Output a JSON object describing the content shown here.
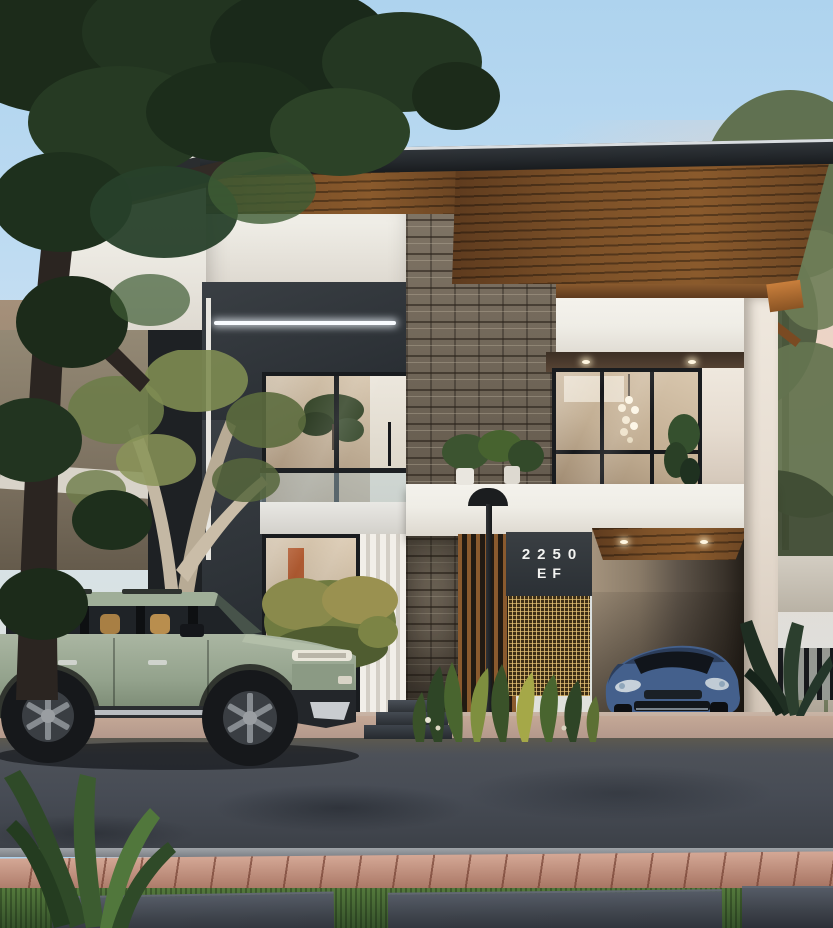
{
  "house": {
    "number_line1": "2250",
    "number_line2": "EF"
  },
  "palette": {
    "skyTop": "#aed3ee",
    "skyPink": "#f3d2be",
    "roofDark": "#24282c",
    "soffitWood": "#8a5a2c",
    "slatWood": "#9a6835",
    "stoneBase": "#867b6c",
    "stuccoWhite": "#efede6",
    "charcoal": "#2e3338",
    "glassWarm": "#c5b49c",
    "signPanel": "#33383c",
    "signText": "#f4f4f2",
    "brassMesh": "#a58445",
    "suvGreen": "#9cab94",
    "sedanBlue": "#49648c",
    "roadAsphalt": "#474c55",
    "paverPink": "#bd8672",
    "grass": "#3f6030",
    "slabGrey": "#3e434b",
    "treeDark": "#22321f",
    "oliveTree": "#5c6b48",
    "lampBlack": "#1b1d1f",
    "ledStrip": "#f8fbff",
    "interiorWarm": "#c49e6d"
  }
}
